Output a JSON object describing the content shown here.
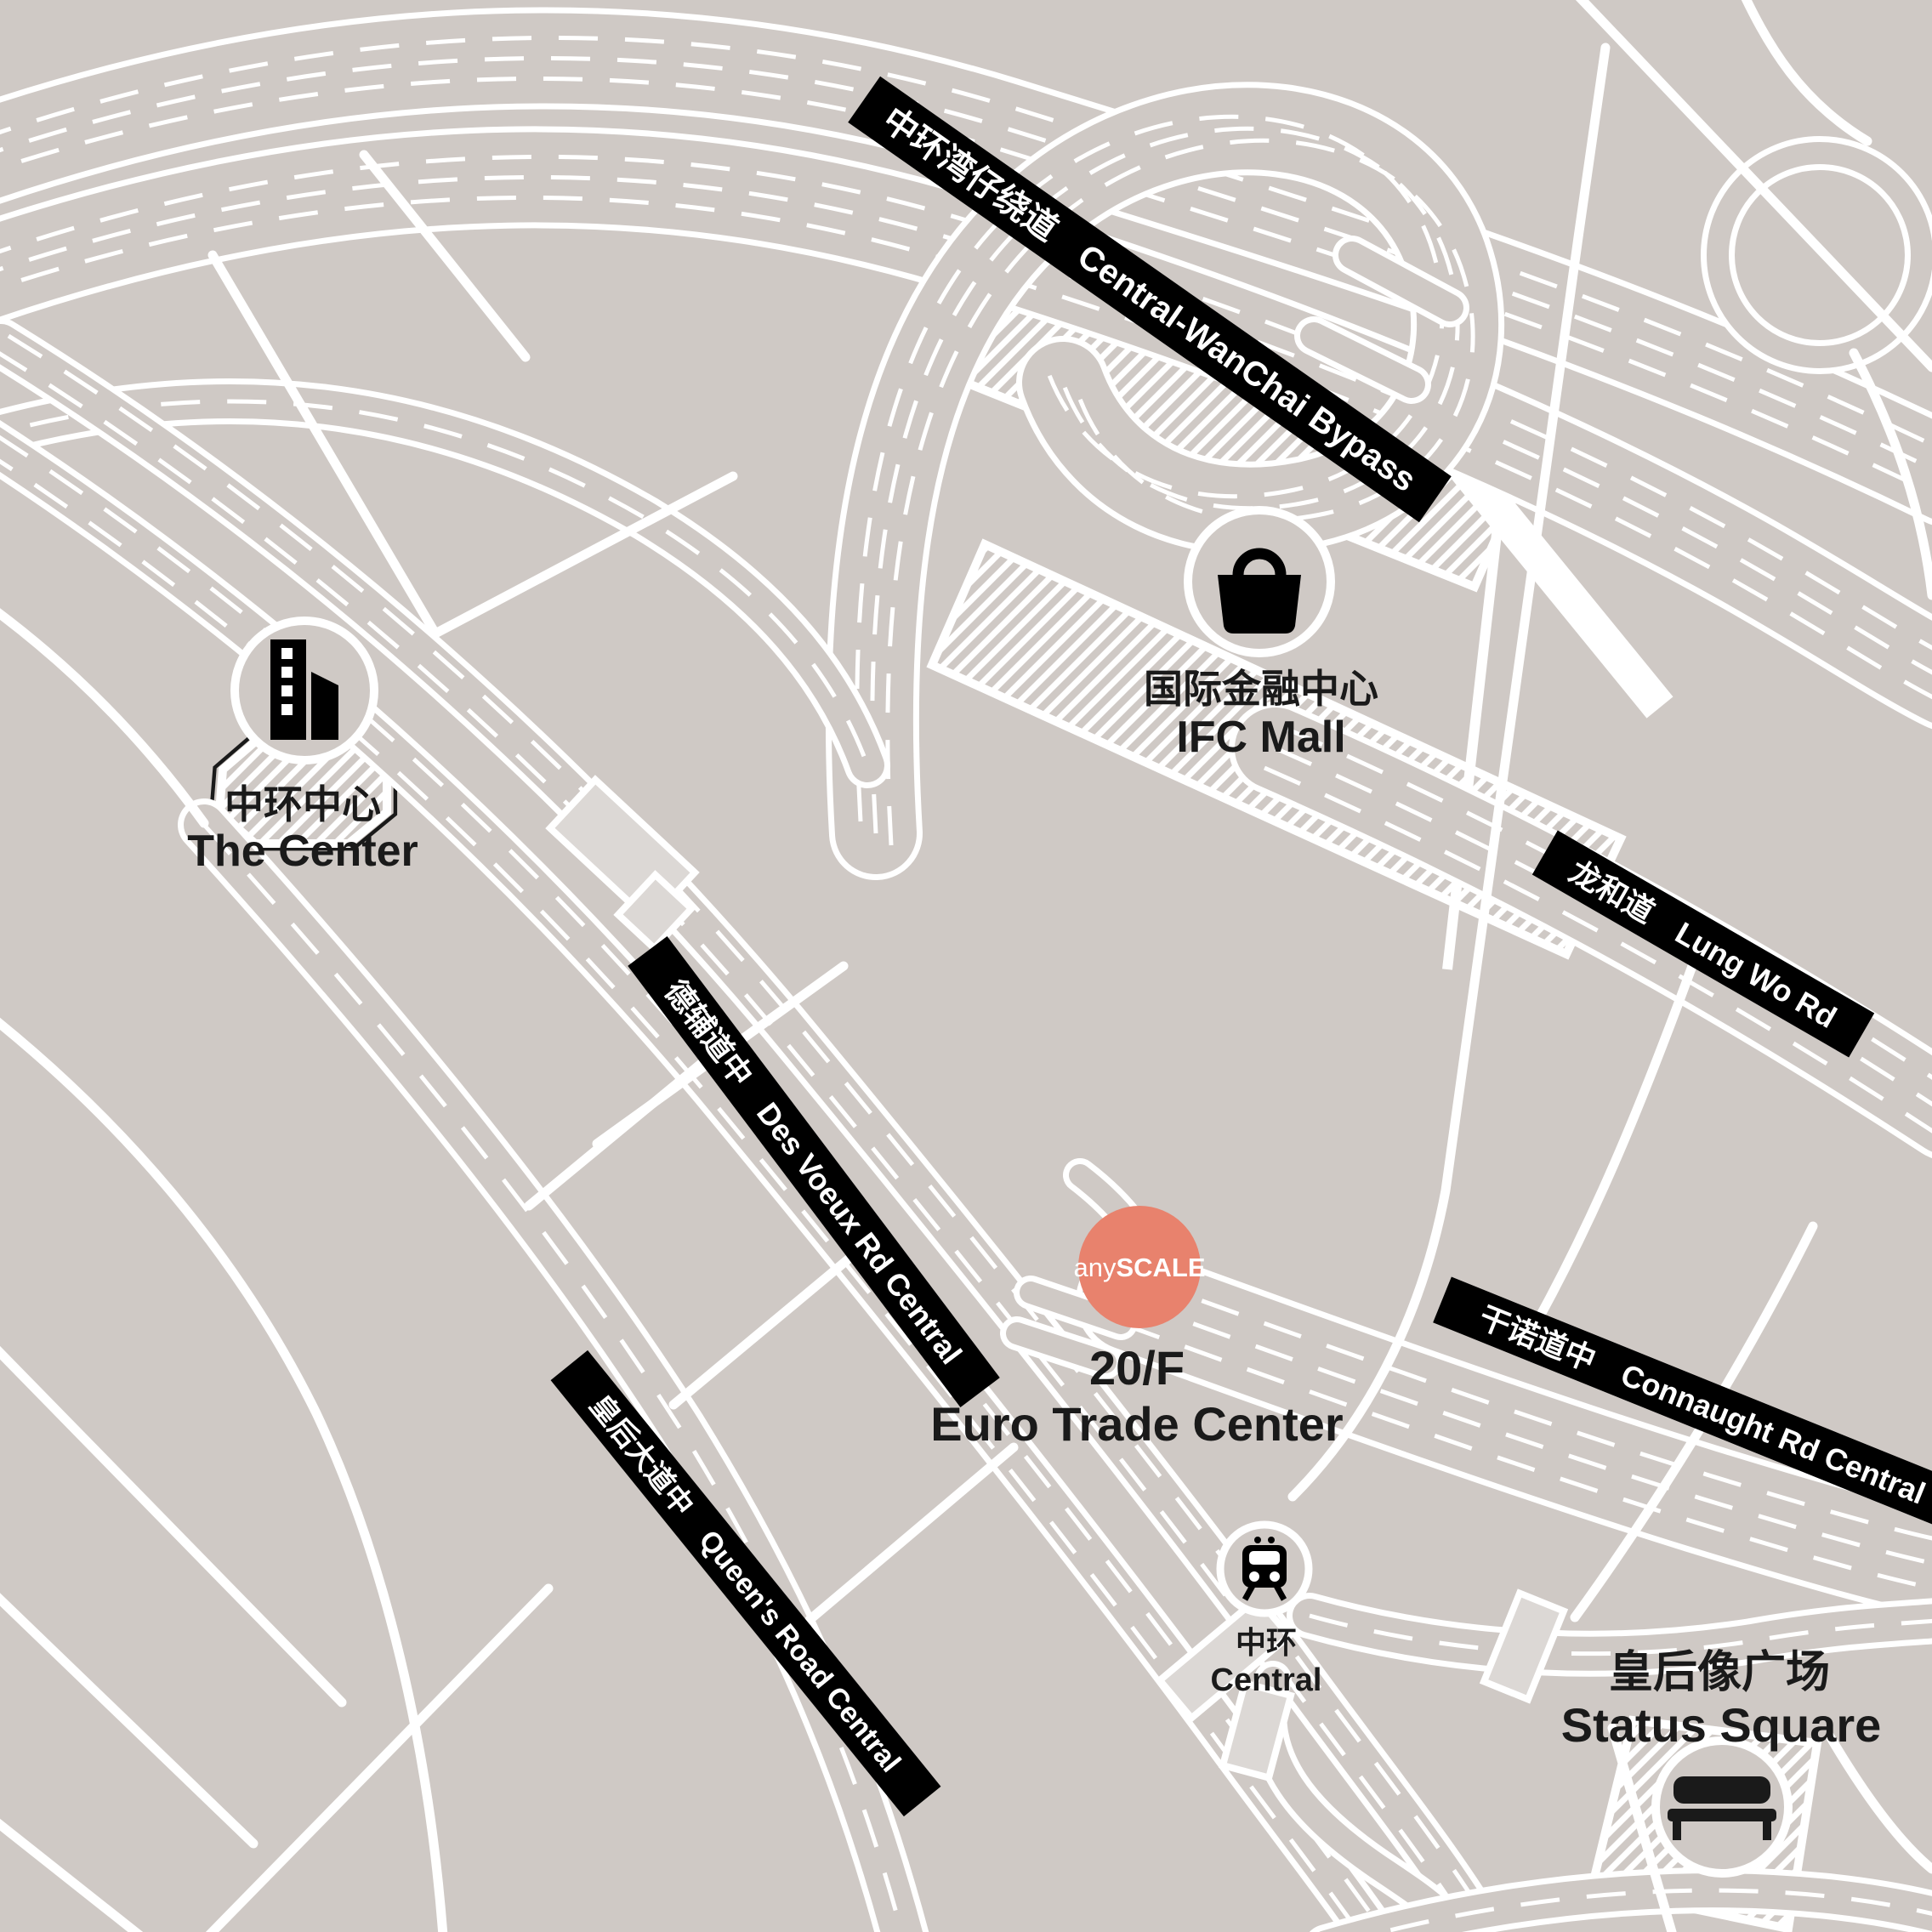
{
  "colors": {
    "background": "#cfc9c5",
    "road": "#ffffff",
    "banner": "#000000",
    "ink": "#1a1a1a",
    "accent": "#e8826d",
    "overpass": "#dcd8d5"
  },
  "banners": {
    "bypass": {
      "zh": "中环湾仔绕道",
      "en": "Central-WanChai Bypass"
    },
    "lung_wo": {
      "zh": "龙和道",
      "en": "Lung Wo Rd"
    },
    "des_voeux": {
      "zh": "德辅道中",
      "en": "Des Voeux Rd Central"
    },
    "queens": {
      "zh": "皇后大道中",
      "en": "Queen's Road Central"
    },
    "connaught": {
      "zh": "干诺道中",
      "en": "Connaught Rd Central"
    }
  },
  "landmarks": {
    "the_center": {
      "zh": "中环中心",
      "en": "The Center"
    },
    "ifc_mall": {
      "zh": "国际金融中心",
      "en": "IFC Mall"
    },
    "central_station": {
      "zh": "中环",
      "en": "Central"
    },
    "status_square": {
      "zh": "皇后像广场",
      "en": "Status Square"
    }
  },
  "marker": {
    "brand_light": "any",
    "brand_bold": "SCALE",
    "floor": "20/F",
    "building": "Euro Trade Center"
  }
}
